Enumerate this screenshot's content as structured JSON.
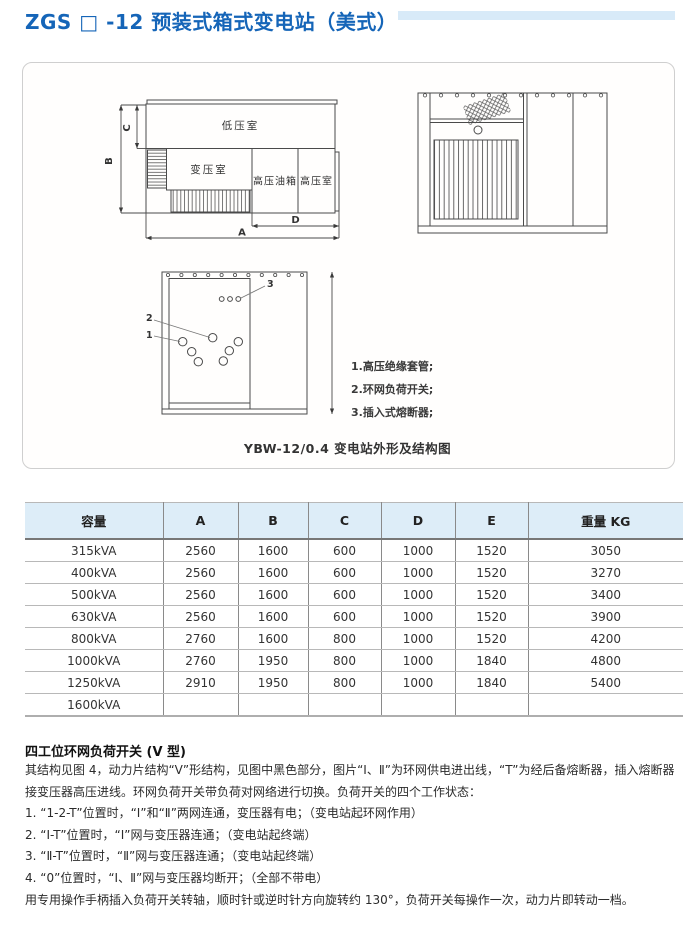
{
  "page": {
    "title": "ZGS □ -12 预装式箱式变电站（美式）"
  },
  "figure": {
    "caption": "YBW-12/0.4 变电站外形及结构图",
    "plan": {
      "low_voltage_room": "低压室",
      "transformer_room": "变压室",
      "hv_oil_tank": "高压油箱",
      "hv_room": "高压室",
      "dim_a": "A",
      "dim_b": "B",
      "dim_c": "C",
      "dim_d": "D"
    },
    "structure": {
      "callout_1": "1",
      "callout_2": "2",
      "callout_3": "3"
    },
    "legend": [
      "1.高压绝缘套管;",
      "2.环网负荷开关;",
      "3.插入式熔断器;"
    ]
  },
  "table": {
    "headers": [
      "容量",
      "A",
      "B",
      "C",
      "D",
      "E",
      "重量 KG"
    ],
    "rows": [
      [
        "315kVA",
        "2560",
        "1600",
        "600",
        "1000",
        "1520",
        "3050"
      ],
      [
        "400kVA",
        "2560",
        "1600",
        "600",
        "1000",
        "1520",
        "3270"
      ],
      [
        "500kVA",
        "2560",
        "1600",
        "600",
        "1000",
        "1520",
        "3400"
      ],
      [
        "630kVA",
        "2560",
        "1600",
        "600",
        "1000",
        "1520",
        "3900"
      ],
      [
        "800kVA",
        "2760",
        "1600",
        "800",
        "1000",
        "1520",
        "4200"
      ],
      [
        "1000kVA",
        "2760",
        "1950",
        "800",
        "1000",
        "1840",
        "4800"
      ],
      [
        "1250kVA",
        "2910",
        "1950",
        "800",
        "1000",
        "1840",
        "5400"
      ],
      [
        "1600kVA",
        "",
        "",
        "",
        "",
        "",
        ""
      ]
    ]
  },
  "switch_section": {
    "heading": "四工位环网负荷开关 (V 型)",
    "para_intro": "其结构见图 4，动力片结构“V”形结构，见图中黑色部分，图片“Ⅰ、Ⅱ”为环网供电进出线，“T”为经后备熔断器，插入熔断器接变压器高压进线。环网负荷开关带负荷对网络进行切换。负荷开关的四个工作状态：",
    "items": [
      "1. “1-2-T”位置时，“Ⅰ”和“Ⅱ”两网连通，变压器有电；（变电站起环网作用）",
      "2. “Ⅰ-T”位置时，“Ⅰ”网与变压器连通；（变电站起终端）",
      "3. “Ⅱ-T”位置时，“Ⅱ”网与变压器连通；（变电站起终端）",
      "4. “0”位置时，“Ⅰ、Ⅱ”网与变压器均断开；（全部不带电）"
    ],
    "para_operation": "用专用操作手柄插入负荷开关转轴，顺时针或逆时针方向旋转约 130°，负荷开关每操作一次，动力片即转动一档。"
  },
  "colors": {
    "title_blue": "#1565b8",
    "accent_bar": "#d8eaf8",
    "table_header_bg": "#ddedf8"
  }
}
